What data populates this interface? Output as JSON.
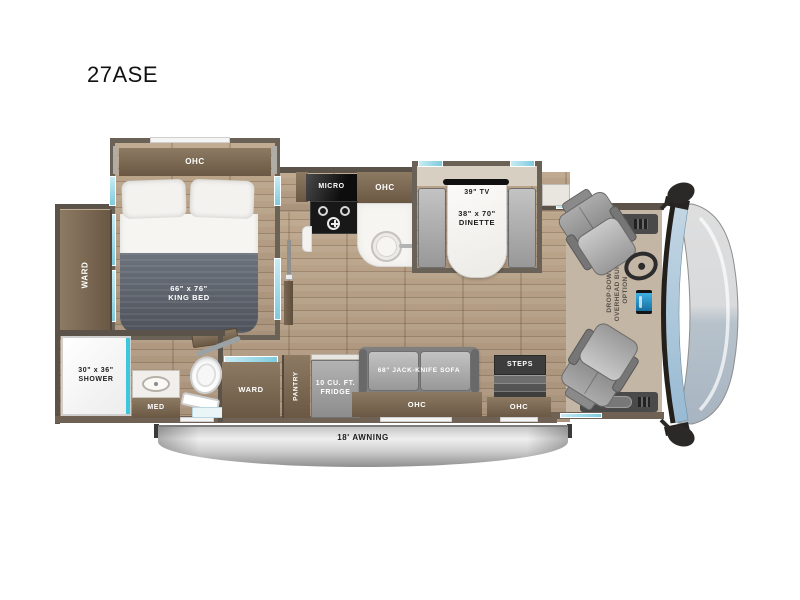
{
  "page": {
    "title": "27ASE"
  },
  "floorplan": {
    "bedroom": {
      "ohc": "OHC",
      "bed_size": "66\" x 76\"",
      "bed_type": "KING BED",
      "ward": "WARD"
    },
    "bathroom": {
      "shower_size": "30\" x 36\"",
      "shower": "SHOWER",
      "med": "MED"
    },
    "kitchen": {
      "micro": "MICRO",
      "ohc": "OHC"
    },
    "dinette": {
      "tv": "39\" TV",
      "size": "38\" x 70\"",
      "label": "DINETTE"
    },
    "midship": {
      "ward": "WARD",
      "pantry": "PANTRY",
      "fridge_line1": "10 CU. FT.",
      "fridge_line2": "FRIDGE"
    },
    "living": {
      "sofa": "68\" JACK-KNIFE SOFA",
      "ohc": "OHC"
    },
    "entry": {
      "steps": "STEPS",
      "ohc": "OHC"
    },
    "cab": {
      "bunk_line1": "DROP-DOWN",
      "bunk_line2": "OVERHEAD BUNK",
      "bunk_line3": "OPTION"
    },
    "exterior": {
      "awning": "18' AWNING"
    }
  },
  "colors": {
    "wood_cabinet": "#7d6a54",
    "floor_plank": "#b49e85",
    "wall": "#5b5349",
    "window_teal": "#7ecadd",
    "mattress": "#565c66",
    "furniture_gray": "#a0a0a0",
    "windshield": "#a9c5d8",
    "awning_silver": "#cfcfcf"
  }
}
